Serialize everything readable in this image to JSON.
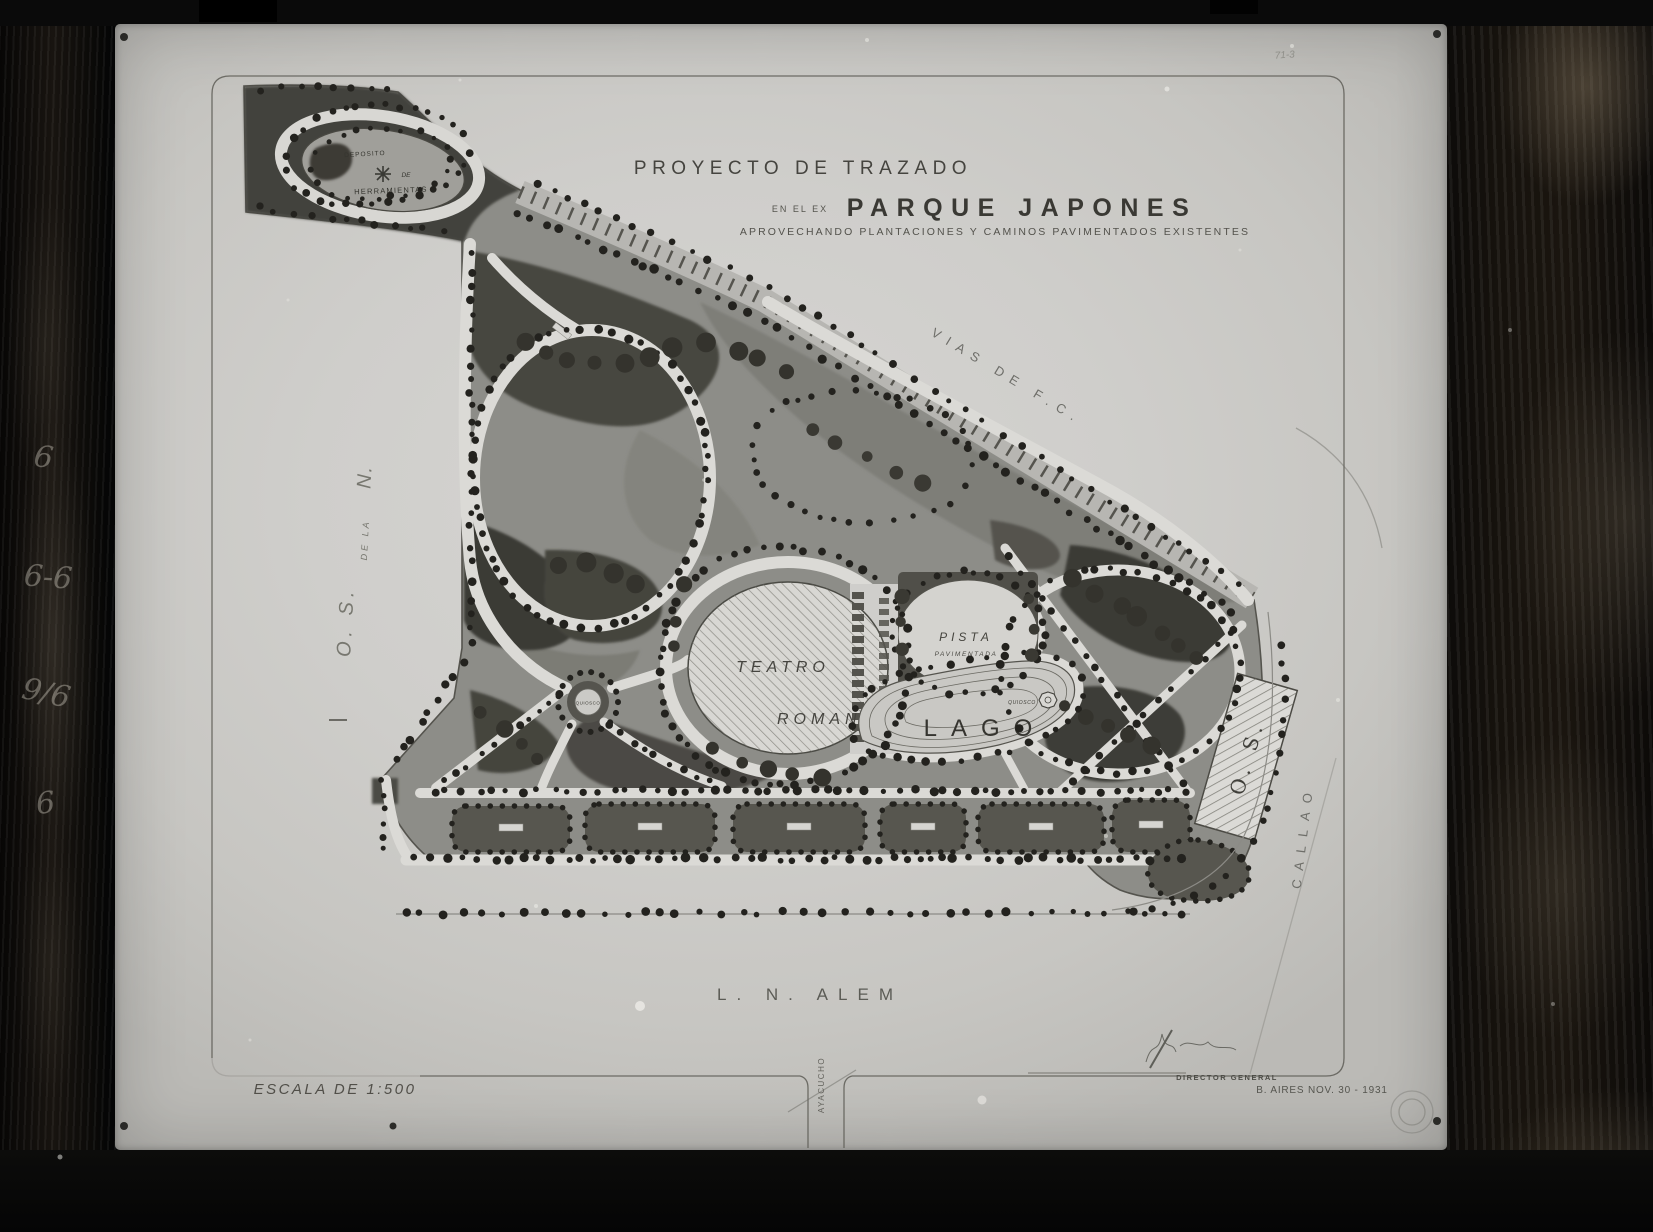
{
  "plate": {
    "frame_number": "71-3",
    "edge_markings": [
      "6",
      "6-6",
      "9/6",
      "6"
    ]
  },
  "title": {
    "line1": "PROYECTO DE TRAZADO",
    "line2_prefix": "EN EL EX",
    "line2_main": "PARQUE JAPONES",
    "line3": "APROVECHANDO PLANTACIONES Y CAMINOS PAVIMENTADOS EXISTENTES"
  },
  "map": {
    "deposito": {
      "line1": "DEPOSITO",
      "line2": "DE",
      "line3": "HERRAMIENTAS"
    },
    "teatro": {
      "line1": "TEATRO",
      "line2": "ROMANO"
    },
    "pista": {
      "line1": "PISTA",
      "line2": "PAVIMENTADA"
    },
    "lago_label": "LAGO",
    "quiosco_lago_label": "QUIOSCO",
    "quiosco_plaza_label": "QUIOSCO",
    "os_building_label": "O. S."
  },
  "streets": {
    "railway_label": "VIAS DE F.C.",
    "west_part1": "O. S.",
    "west_part2": "DE LA",
    "west_part3": "N.",
    "east_label": "CALLAO",
    "south_label": "L. N. ALEM",
    "south_cross_label": "AYACUCHO"
  },
  "footer": {
    "scale_label": "ESCALA DE 1:500",
    "signature_role": "DIRECTOR GENERAL",
    "place_date": "B. AIRES NOV. 30 - 1931"
  },
  "colors": {
    "paper": "#cfcecb",
    "ink": "#3a3934",
    "lawn": "#8d8d88",
    "tree": "#23221e"
  }
}
